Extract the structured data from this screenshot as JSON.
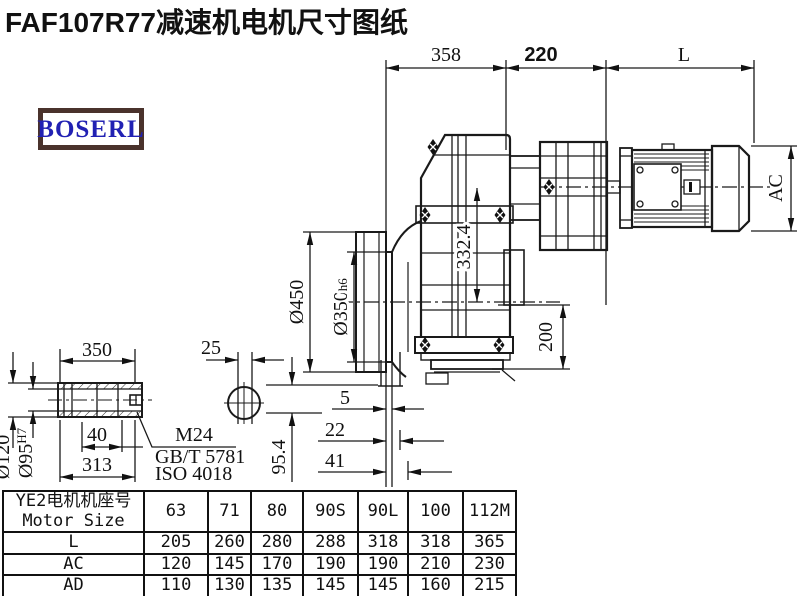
{
  "title": "FAF107R77减速机电机尺寸图纸",
  "logo": {
    "text": "BOSERL"
  },
  "colors": {
    "line": "#1a1a1a",
    "logo_text": "#2121b3",
    "logo_border": "#4a322c"
  },
  "dims": {
    "top_358": "358",
    "top_220": "220",
    "top_L": "L",
    "ac": "AC",
    "d450": "Ø450",
    "d350": "Ø350",
    "d350_suffix": "h6",
    "v332": "332.4",
    "v200": "200",
    "b5": "5",
    "b22": "22",
    "b41": "41",
    "v954": "95.4",
    "s350": "350",
    "s25": "25",
    "s40": "40",
    "s313": "313",
    "d120": "Ø120",
    "d95": "Ø95",
    "d95_sup": "H7",
    "m24": "M24",
    "gbt": "GB/T 5781",
    "iso": "ISO 4018"
  },
  "table": {
    "header_cn": "YE2电机机座号",
    "header_en": "Motor Size",
    "columns": [
      "63",
      "71",
      "80",
      "90S",
      "90L",
      "100",
      "112M"
    ],
    "rows": [
      {
        "label": "L",
        "values": [
          "205",
          "260",
          "280",
          "288",
          "318",
          "318",
          "365"
        ]
      },
      {
        "label": "AC",
        "values": [
          "120",
          "145",
          "170",
          "190",
          "190",
          "210",
          "230"
        ]
      },
      {
        "label": "AD",
        "values": [
          "110",
          "130",
          "135",
          "145",
          "145",
          "160",
          "215"
        ]
      }
    ]
  }
}
